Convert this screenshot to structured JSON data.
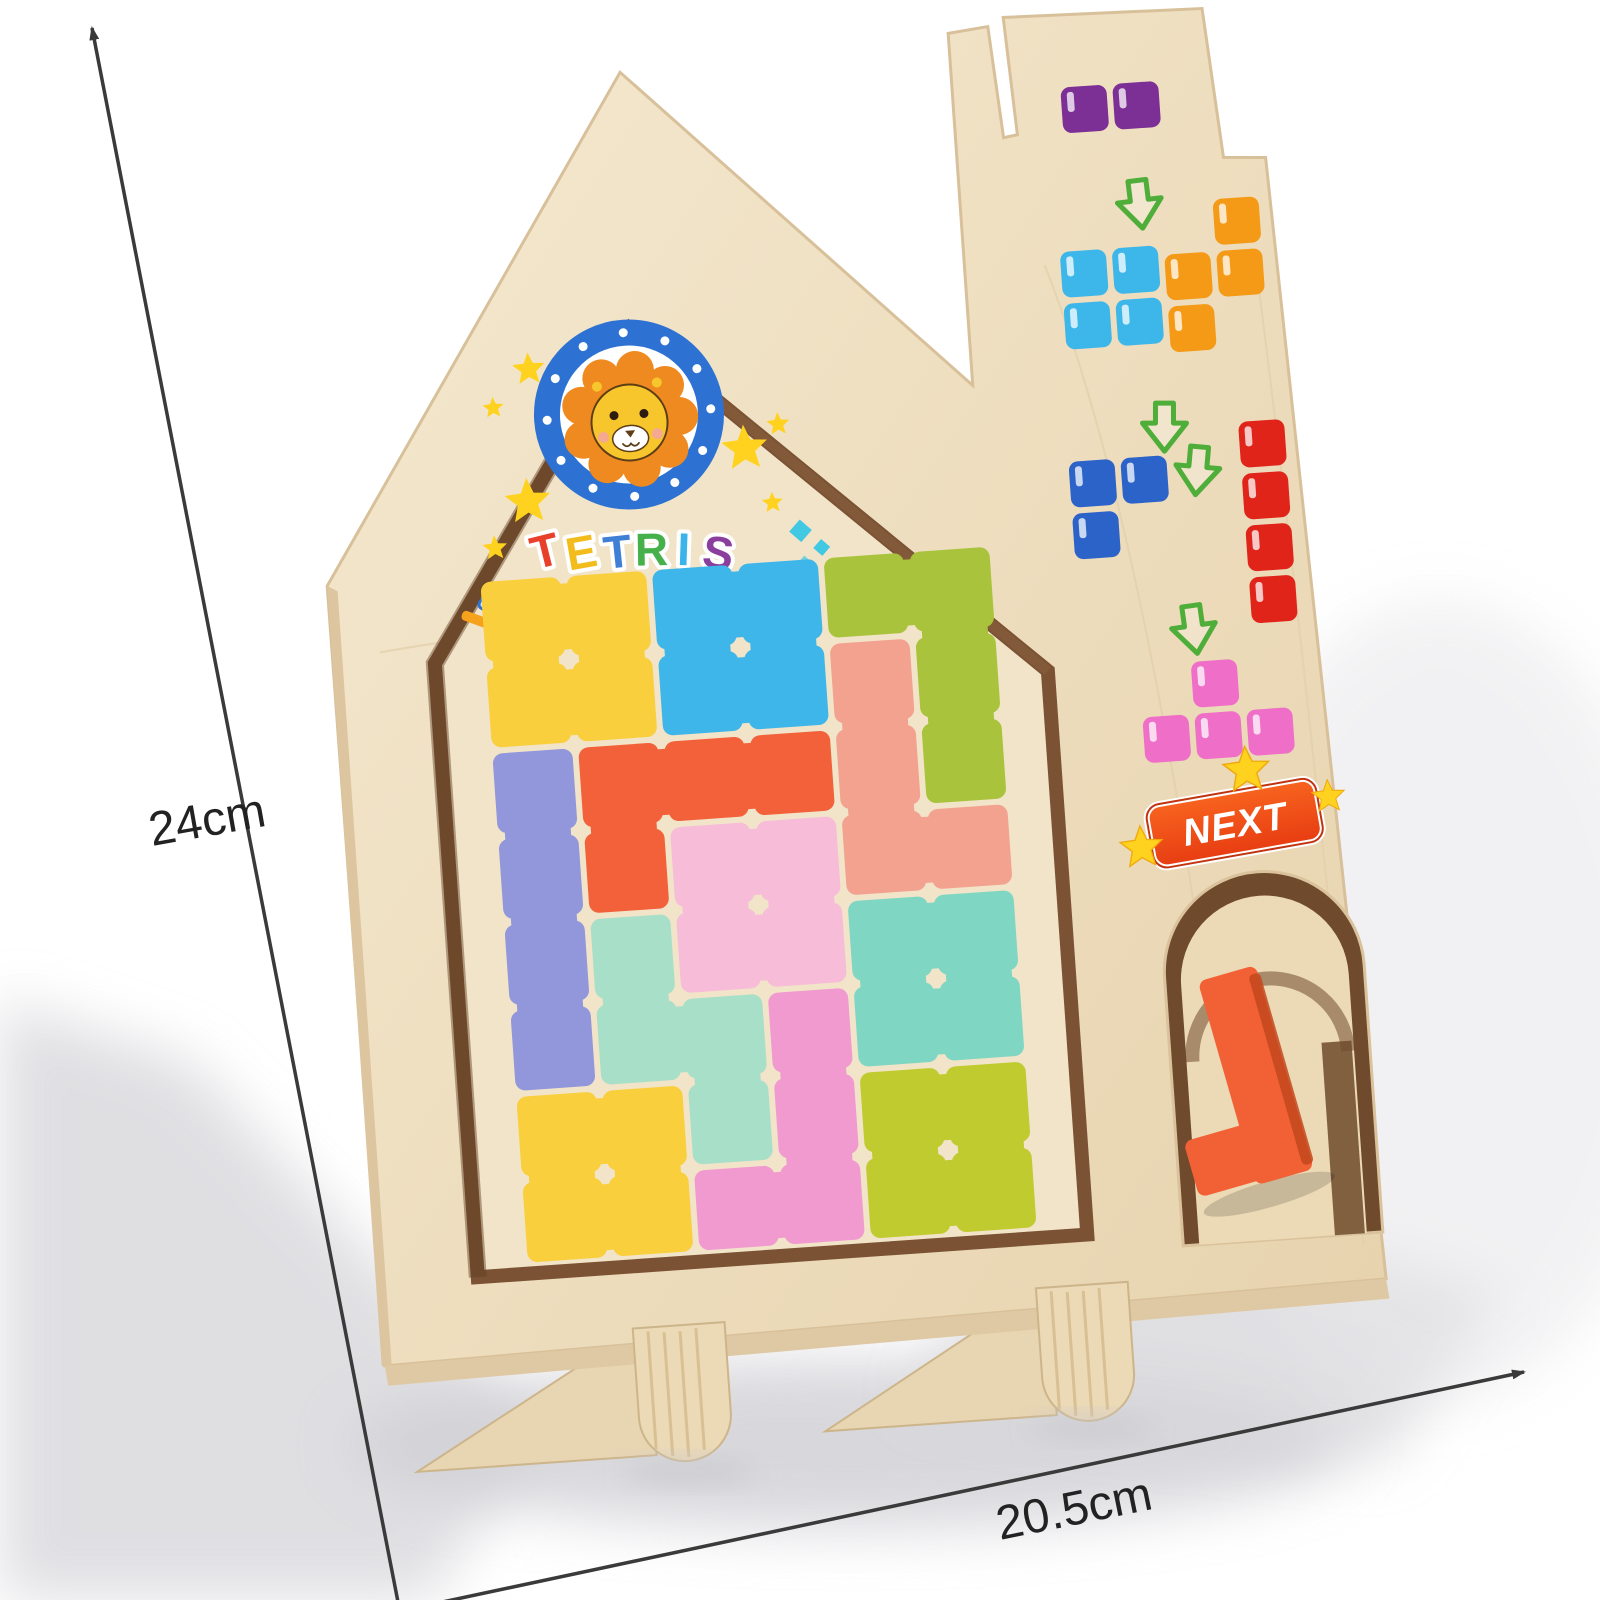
{
  "dimensions": {
    "height_label": "24cm",
    "width_label": "20.5cm"
  },
  "logo": {
    "title": "TETRIS",
    "letters": [
      {
        "char": "T",
        "color": "#e8402a"
      },
      {
        "char": "E",
        "color": "#f2bd1c"
      },
      {
        "char": "T",
        "color": "#3f7fd6"
      },
      {
        "char": "R",
        "color": "#46b14a"
      },
      {
        "char": "I",
        "color": "#3ab4e9"
      },
      {
        "char": "S",
        "color": "#8a3f9e"
      }
    ],
    "lion": {
      "mane": "#ef8a20",
      "face": "#f7c62c",
      "ring": "#2d72d3",
      "outline": "#5d3d16",
      "blush": "#f5a3a3"
    }
  },
  "badge": {
    "label": "NEXT",
    "bg_top": "#f8641f",
    "bg_bottom": "#e73c12",
    "text_color": "#ffffff"
  },
  "palette": {
    "background": "#ffffff",
    "wood_light": "#f2e5ca",
    "wood_mid": "#ead9b8",
    "wood_edge": "#d8c09a",
    "recess_dark": "#7b5233",
    "panel": "#f2e4c8",
    "arrow_green": "#4fae39",
    "star_yellow": "#ffd21f",
    "diamond_teal": "#41c8e2",
    "pink_square": "#f06ec8",
    "dimension_line": "#3a3a3a",
    "window_wall": "#6f4a2c",
    "window_floor": "#ecd9b5",
    "window_piece_orange": "#f26135",
    "window_piece_shade": "#c4481d"
  },
  "puzzle": {
    "cell": 86,
    "origin": [
      442,
      574
    ],
    "pieces": [
      {
        "color": "#f9cf3d",
        "cells": [
          [
            0,
            0
          ],
          [
            1,
            0
          ],
          [
            0,
            1
          ],
          [
            1,
            1
          ]
        ]
      },
      {
        "color": "#3fb6ea",
        "cells": [
          [
            2,
            0
          ],
          [
            3,
            0
          ],
          [
            2,
            1
          ],
          [
            3,
            1
          ]
        ]
      },
      {
        "color": "#a9c33c",
        "cells": [
          [
            4,
            0
          ],
          [
            5,
            0
          ],
          [
            5,
            1
          ],
          [
            5,
            2
          ]
        ]
      },
      {
        "color": "#f2a28e",
        "cells": [
          [
            4,
            1
          ],
          [
            4,
            2
          ],
          [
            4,
            3
          ],
          [
            5,
            3
          ]
        ]
      },
      {
        "color": "#9297dc",
        "cells": [
          [
            0,
            2
          ],
          [
            0,
            3
          ],
          [
            0,
            4
          ],
          [
            0,
            5
          ]
        ]
      },
      {
        "color": "#f2613a",
        "cells": [
          [
            1,
            2
          ],
          [
            2,
            2
          ],
          [
            3,
            2
          ],
          [
            1,
            3
          ]
        ]
      },
      {
        "color": "#f6bcd8",
        "cells": [
          [
            2,
            3
          ],
          [
            3,
            3
          ],
          [
            2,
            4
          ],
          [
            3,
            4
          ]
        ]
      },
      {
        "color": "#a8dfc9",
        "cells": [
          [
            1,
            4
          ],
          [
            1,
            5
          ],
          [
            2,
            5
          ],
          [
            2,
            6
          ]
        ]
      },
      {
        "color": "#7fd7c3",
        "cells": [
          [
            4,
            4
          ],
          [
            5,
            4
          ],
          [
            4,
            5
          ],
          [
            5,
            5
          ]
        ]
      },
      {
        "color": "#f09ad0",
        "cells": [
          [
            3,
            5
          ],
          [
            3,
            6
          ],
          [
            3,
            7
          ],
          [
            2,
            7
          ]
        ]
      },
      {
        "color": "#f9cf3d",
        "cells": [
          [
            0,
            6
          ],
          [
            1,
            6
          ],
          [
            0,
            7
          ],
          [
            1,
            7
          ]
        ]
      },
      {
        "color": "#bfcb2f",
        "cells": [
          [
            4,
            6
          ],
          [
            5,
            6
          ],
          [
            4,
            7
          ],
          [
            5,
            7
          ]
        ]
      }
    ]
  },
  "stickers": {
    "square": 46,
    "gap": 6,
    "items": [
      {
        "type": "piece",
        "name": "sticker-domino-purple",
        "color": "#7c2f95",
        "origin": [
          1058,
          124
        ],
        "cells": [
          [
            0,
            0
          ],
          [
            1,
            0
          ]
        ]
      },
      {
        "type": "arrow",
        "name": "down-arrow-icon",
        "at": [
          1128,
          222
        ],
        "rot": -3
      },
      {
        "type": "piece",
        "name": "sticker-o-skyblue",
        "color": "#3db6ea",
        "origin": [
          1046,
          288
        ],
        "cells": [
          [
            0,
            0
          ],
          [
            1,
            0
          ],
          [
            0,
            1
          ],
          [
            1,
            1
          ]
        ]
      },
      {
        "type": "arrow",
        "name": "down-arrow-icon",
        "at": [
          1140,
          446
        ],
        "rot": 4
      },
      {
        "type": "piece",
        "name": "sticker-s-orange",
        "color": "#f49a16",
        "origin": [
          1150,
          246
        ],
        "cells": [
          [
            1,
            0
          ],
          [
            0,
            1
          ],
          [
            1,
            1
          ],
          [
            0,
            2
          ]
        ]
      },
      {
        "type": "piece",
        "name": "sticker-corner-blue",
        "color": "#2b63c9",
        "origin": [
          1040,
          498
        ],
        "cells": [
          [
            0,
            0
          ],
          [
            1,
            0
          ],
          [
            0,
            1
          ]
        ]
      },
      {
        "type": "arrow",
        "name": "down-arrow-icon",
        "at": [
          1172,
          492
        ],
        "rot": 9
      },
      {
        "type": "piece",
        "name": "sticker-i-red",
        "color": "#e0241a",
        "origin": [
          1212,
          470
        ],
        "cells": [
          [
            0,
            0
          ],
          [
            0,
            1
          ],
          [
            0,
            2
          ],
          [
            0,
            3
          ]
        ]
      },
      {
        "type": "arrow",
        "name": "down-arrow-icon",
        "at": [
          1152,
          650
        ],
        "rot": -4
      },
      {
        "type": "piece",
        "name": "sticker-t-pink",
        "color": "#ef6ec7",
        "origin": [
          1096,
          706
        ],
        "cells": [
          [
            1,
            0
          ],
          [
            0,
            1
          ],
          [
            1,
            1
          ],
          [
            2,
            1
          ]
        ]
      }
    ]
  }
}
